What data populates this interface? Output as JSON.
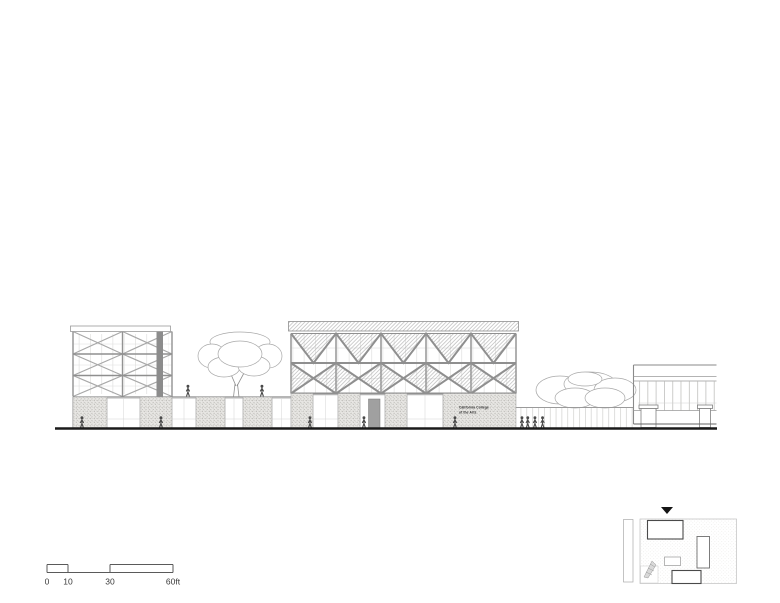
{
  "drawing": {
    "type": "architectural-elevation",
    "sign": {
      "line1": "California College",
      "line2": "of the Arts"
    }
  },
  "scale_bar": {
    "labels": [
      "0",
      "10",
      "30",
      "60ft"
    ]
  },
  "colors": {
    "paper": "#ffffff",
    "ground_ink": "#1a1a1a",
    "line_grey": "#8f8f8f",
    "light_line": "#c9c9c9",
    "hatch_grey": "#b0b0b0",
    "stipple_bg": "#e8e7e4",
    "figure_grey": "#4a4a4a",
    "marker_black": "#151515"
  }
}
